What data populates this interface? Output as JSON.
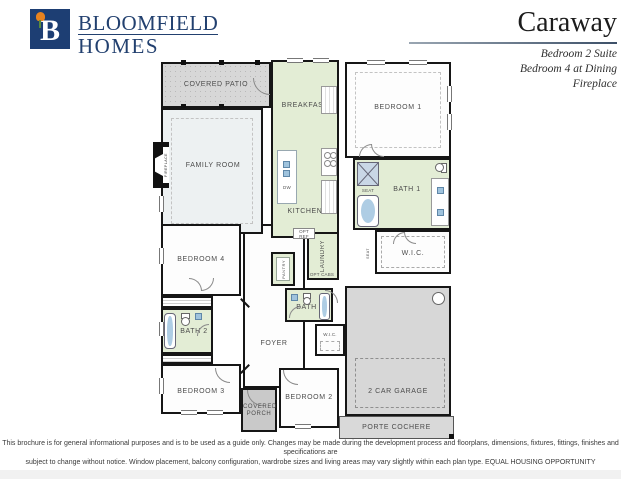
{
  "header": {
    "brand": {
      "monogram": "B",
      "name_line1": "BLOOMFIELD",
      "name_line2": "HOMES",
      "navy": "#1d3e73",
      "tulip_orange": "#e8821e",
      "leaf_green": "#5a8a3c"
    },
    "plan_name": "Caraway",
    "features": [
      "Bedroom 2 Suite",
      "Bedroom 4 at Dining",
      "Fireplace"
    ]
  },
  "floorplan": {
    "colors": {
      "wall": "#161616",
      "outdoor_gray": "#d7d7d7",
      "wet_green": "#e3edd5",
      "living_gray_blue": "#edf1f2",
      "bedroom_white": "#fdfdfd",
      "porch_gray": "#c9c9c9"
    },
    "rooms": {
      "covered_patio": "COVERED PATIO",
      "breakfast": "BREAKFAST",
      "bedroom1": "BEDROOM 1",
      "family_room": "FAMILY ROOM",
      "kitchen": "KITCHEN",
      "bath1": "BATH 1",
      "wic1": "W.I.C.",
      "laundry": "LAUNDRY",
      "pantry": "PANTRY",
      "bedroom4": "BEDROOM 4",
      "bath2": "BATH 2",
      "foyer": "FOYER",
      "bath3": "BATH 3",
      "wic2": "W.I.C.",
      "bedroom3": "BEDROOM 3",
      "covered_porch": "COVERED PORCH",
      "bedroom2": "BEDROOM 2",
      "garage": "2 CAR GARAGE",
      "porte_cochere": "PORTE COCHERE"
    },
    "fixtures": {
      "fireplace": "FIREPLACE",
      "seat": "SEAT",
      "dw": "DW",
      "opt_ref": "OPT REF",
      "opt_cabs": "OPT CABS"
    }
  },
  "footer": {
    "line1": "This brochure is for general informational purposes and is to be used as a guide only. Changes may be made during the development process and floorplans, dimensions, fixtures, fittings, finishes and specifications are",
    "line2": "subject to change without notice. Window placement, balcony configuration, wardrobe sizes and living areas may vary slightly within each plan type.  EQUAL HOUSING OPPORTUNITY"
  }
}
